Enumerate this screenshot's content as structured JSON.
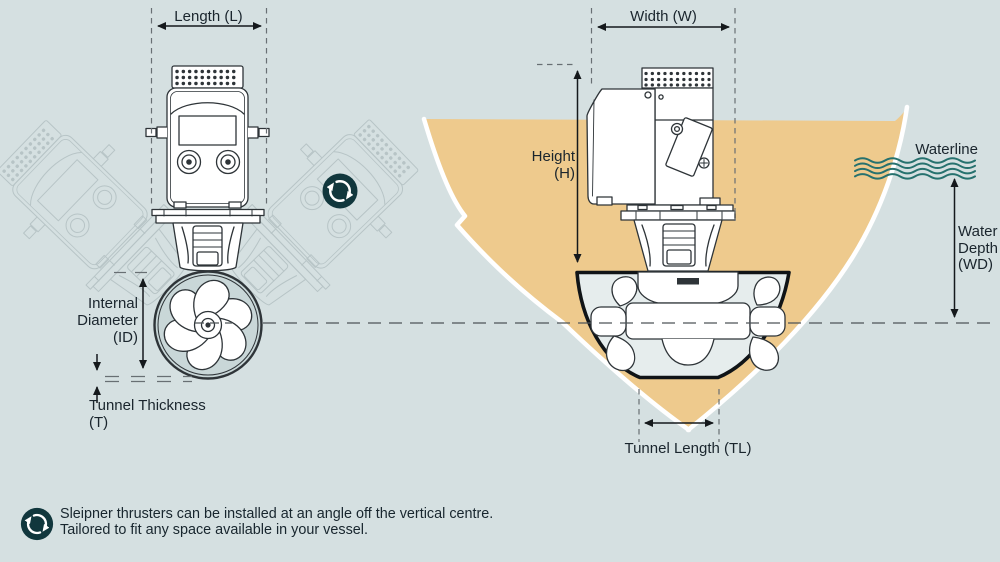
{
  "diagram_title_context": "thruster-installation-dimensions",
  "colors": {
    "background": "#d5e0e1",
    "hull_tan": "#eeca8d",
    "tunnel_interior": "#e6eded",
    "icon_teal": "#11373d",
    "wave_teal": "#26716e",
    "text": "#1a252d",
    "line_art": "#2e3438",
    "ghost_line": "#b7c4c6"
  },
  "left_diagram": {
    "length_label": "Length (L)",
    "internal_diameter": {
      "line1": "Internal",
      "line2": "Diameter",
      "line3": "(ID)"
    },
    "tunnel_thickness": {
      "line1": "Tunnel Thickness",
      "line2": "(T)"
    }
  },
  "right_diagram": {
    "width_label": "Width (W)",
    "height": {
      "line1": "Height",
      "line2": "(H)"
    },
    "waterline_label": "Waterline",
    "water_depth": {
      "line1": "Water",
      "line2": "Depth",
      "line3": "(WD)"
    },
    "tunnel_length_label": "Tunnel Length (TL)"
  },
  "footer": {
    "line1": "Sleipner thrusters can be installed at an angle off the vertical centre.",
    "line2": "Tailored to fit any space available in your vessel."
  },
  "icons": {
    "rotation_main": "rotation-arrows",
    "rotation_footer": "rotation-arrows"
  }
}
